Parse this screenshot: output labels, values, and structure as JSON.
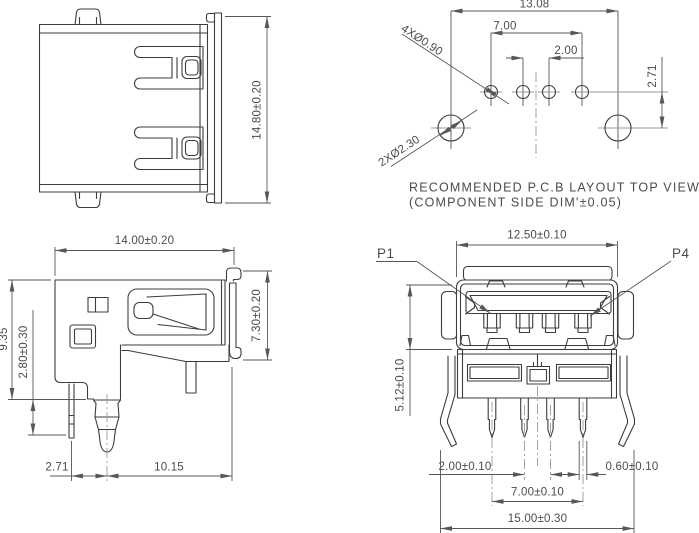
{
  "views": {
    "connector_top_view": {
      "dim_height": "14.80±0.20"
    },
    "pcb_layout": {
      "dim_hole_span": "13.08",
      "dim_pin_span": "7.00",
      "dim_pin_pitch_center": "2.00",
      "dim_row_offset": "2.71",
      "callout_pin_holes": "4XØ0.90",
      "callout_mount_holes": "2XØ2.30",
      "caption_line1": "RECOMMENDED P.C.B LAYOUT TOP VIEW",
      "caption_line2": "(COMPONENT SIDE DIM'±0.05)"
    },
    "side_view": {
      "dim_depth": "14.00±0.20",
      "dim_body_height": "9.35",
      "dim_standoff": "2.80±0.30",
      "dim_flange_height": "7.30±0.20",
      "dim_pin_to_peg": "2.71",
      "dim_peg_to_back": "10.15"
    },
    "front_view": {
      "dim_shell_width": "12.50±0.10",
      "dim_shell_height": "5.12±0.10",
      "dim_pin_pitch_center": "2.00±0.10",
      "dim_pin_width": "0.60±0.10",
      "dim_pin_span": "7.00±0.10",
      "dim_overall_width": "15.00±0.30",
      "label_pin1": "P1",
      "label_pin4": "P4"
    }
  },
  "colors": {
    "background": "#ffffff",
    "geometry_line": "#3d3d3d",
    "dimension_line": "#575757",
    "centerline": "#9a9a9a",
    "text": "#4b4b4b"
  }
}
